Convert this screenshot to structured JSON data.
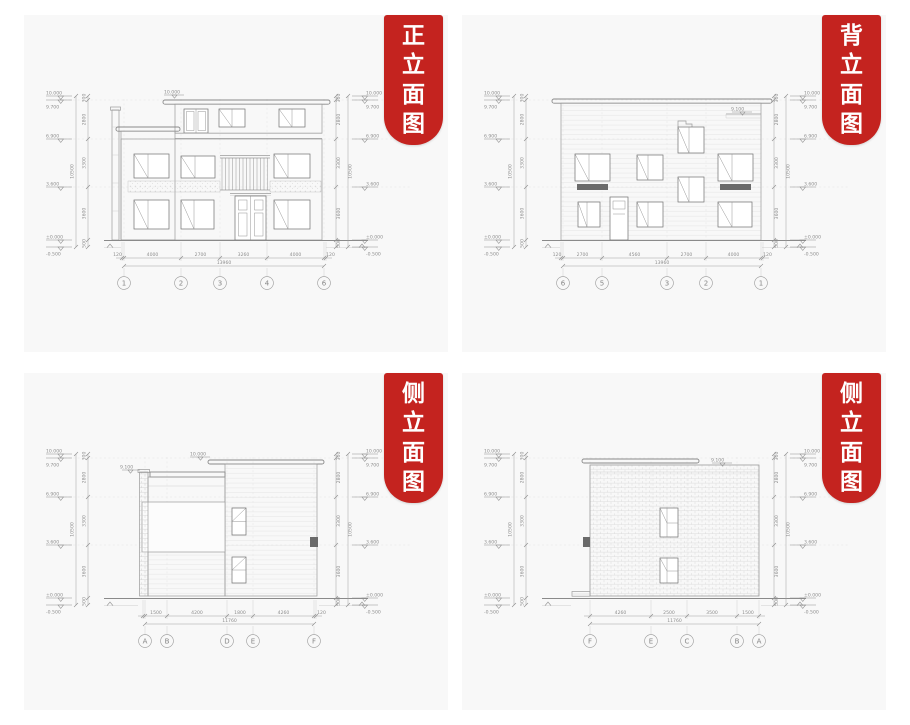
{
  "page": {
    "background": "#ffffff",
    "panel_background": "#f8f8f8"
  },
  "ribbon": {
    "background": "#c4231f",
    "text_color": "#ffffff"
  },
  "drawing": {
    "line_color": "#9b9b9b",
    "text_color": "#8e8e8e"
  },
  "panels": [
    {
      "title": "正立面图",
      "title_chars": [
        "正",
        "立",
        "面",
        "图"
      ],
      "top_marker": "10.000",
      "axes": [
        "1",
        "2",
        "3",
        "4",
        "6"
      ],
      "dims": [
        "120",
        "4000",
        "2700",
        "3260",
        "4000",
        "120"
      ],
      "total": "13960",
      "elev": [
        "10.000",
        "9.700",
        "6.900",
        "3.600",
        "±0.000",
        "-0.500"
      ],
      "vdims": [
        "300",
        "2800",
        "3300",
        "3600",
        "500"
      ],
      "vtotal": "10500"
    },
    {
      "title": "背立面图",
      "title_chars": [
        "背",
        "立",
        "面",
        "图"
      ],
      "roof_marker": "9.100",
      "axes": [
        "6",
        "5",
        "3",
        "2",
        "1"
      ],
      "dims": [
        "120",
        "2700",
        "4560",
        "2700",
        "4000",
        "120"
      ],
      "total": "13960",
      "elev": [
        "10.000",
        "9.700",
        "6.900",
        "3.600",
        "±0.000",
        "-0.500"
      ],
      "vdims": [
        "300",
        "2800",
        "3300",
        "3600",
        "500"
      ],
      "vtotal": "10500"
    },
    {
      "title": "侧立面图",
      "title_chars": [
        "侧",
        "立",
        "面",
        "图"
      ],
      "top_marker": "10.000",
      "roof_marker": "9.100",
      "axes": [
        "A",
        "B",
        "D",
        "E",
        "F"
      ],
      "dims": [
        "1500",
        "4200",
        "1800",
        "4260",
        "120"
      ],
      "total": "11760",
      "elev": [
        "10.000",
        "9.700",
        "6.900",
        "3.600",
        "±0.000",
        "-0.500"
      ],
      "vdims": [
        "300",
        "2800",
        "3300",
        "3600",
        "500"
      ],
      "vtotal": "10500"
    },
    {
      "title": "侧立面图",
      "title_chars": [
        "侧",
        "立",
        "面",
        "图"
      ],
      "roof_marker": "9.100",
      "axes": [
        "F",
        "E",
        "C",
        "B",
        "A"
      ],
      "dims": [
        "4260",
        "2500",
        "3500",
        "1500"
      ],
      "total": "11760",
      "elev": [
        "10.000",
        "9.700",
        "6.900",
        "3.600",
        "±0.000",
        "-0.500"
      ],
      "vdims": [
        "300",
        "2800",
        "3300",
        "3600",
        "500"
      ],
      "vtotal": "10500"
    }
  ]
}
